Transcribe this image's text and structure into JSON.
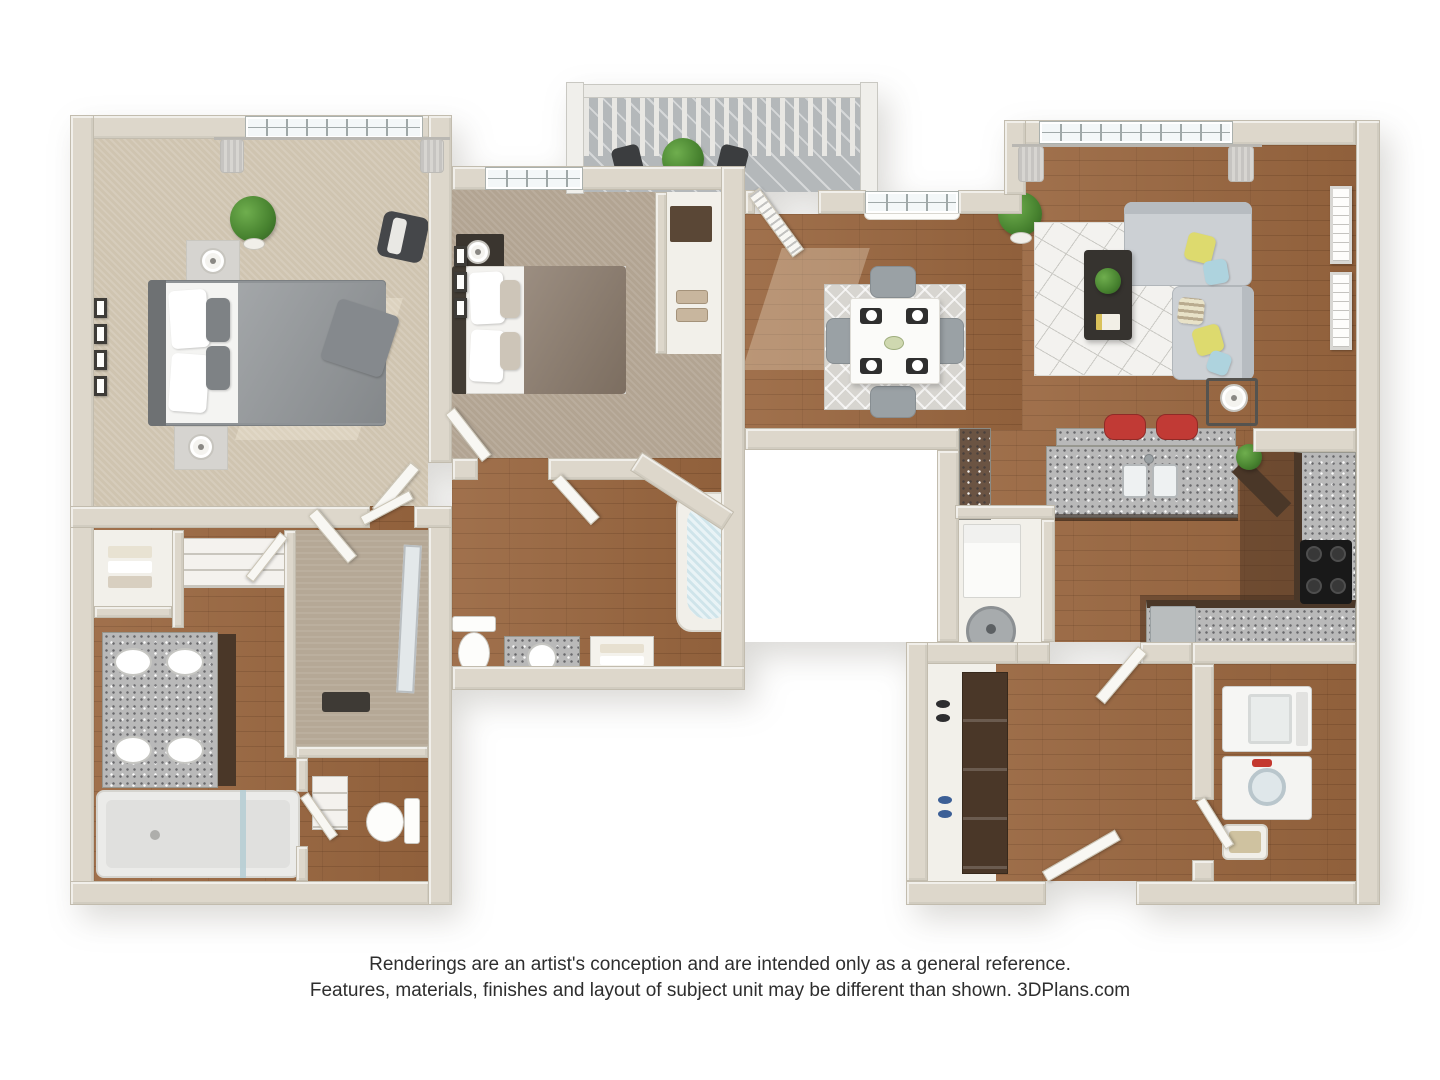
{
  "footer": {
    "line1": "Renderings are an artist's conception and are intended only as a general reference.",
    "line2": "Features, materials, finishes and layout of subject unit may be different than shown. 3DPlans.com"
  },
  "palette": {
    "wall": "#ddd7cb",
    "wall_edge": "#c2bcae",
    "white_face": "#f2f0ea",
    "wood": "#99663f",
    "kitchen_dark": "#5f4a38",
    "carpet1": "#cfc4b0",
    "carpet2": "#b2a492",
    "tan_floor": "#b5a896",
    "granite": "#b9b9b9",
    "cabinet": "#4a3728",
    "sofa": "#ccd0d4",
    "sofa_dark": "#b7bcc1",
    "deck": "#b4b8ba",
    "plant": "#47822f",
    "door": "#f8f7f3",
    "glass": "#f3f7f8",
    "stool": "#c13a35",
    "pillow_yellow": "#ddda6e",
    "pillow_blue": "#aed3de",
    "bed_gray": "#8f9396",
    "bed_taupe": "#8a7a6b",
    "text": "#2e2e2e"
  }
}
